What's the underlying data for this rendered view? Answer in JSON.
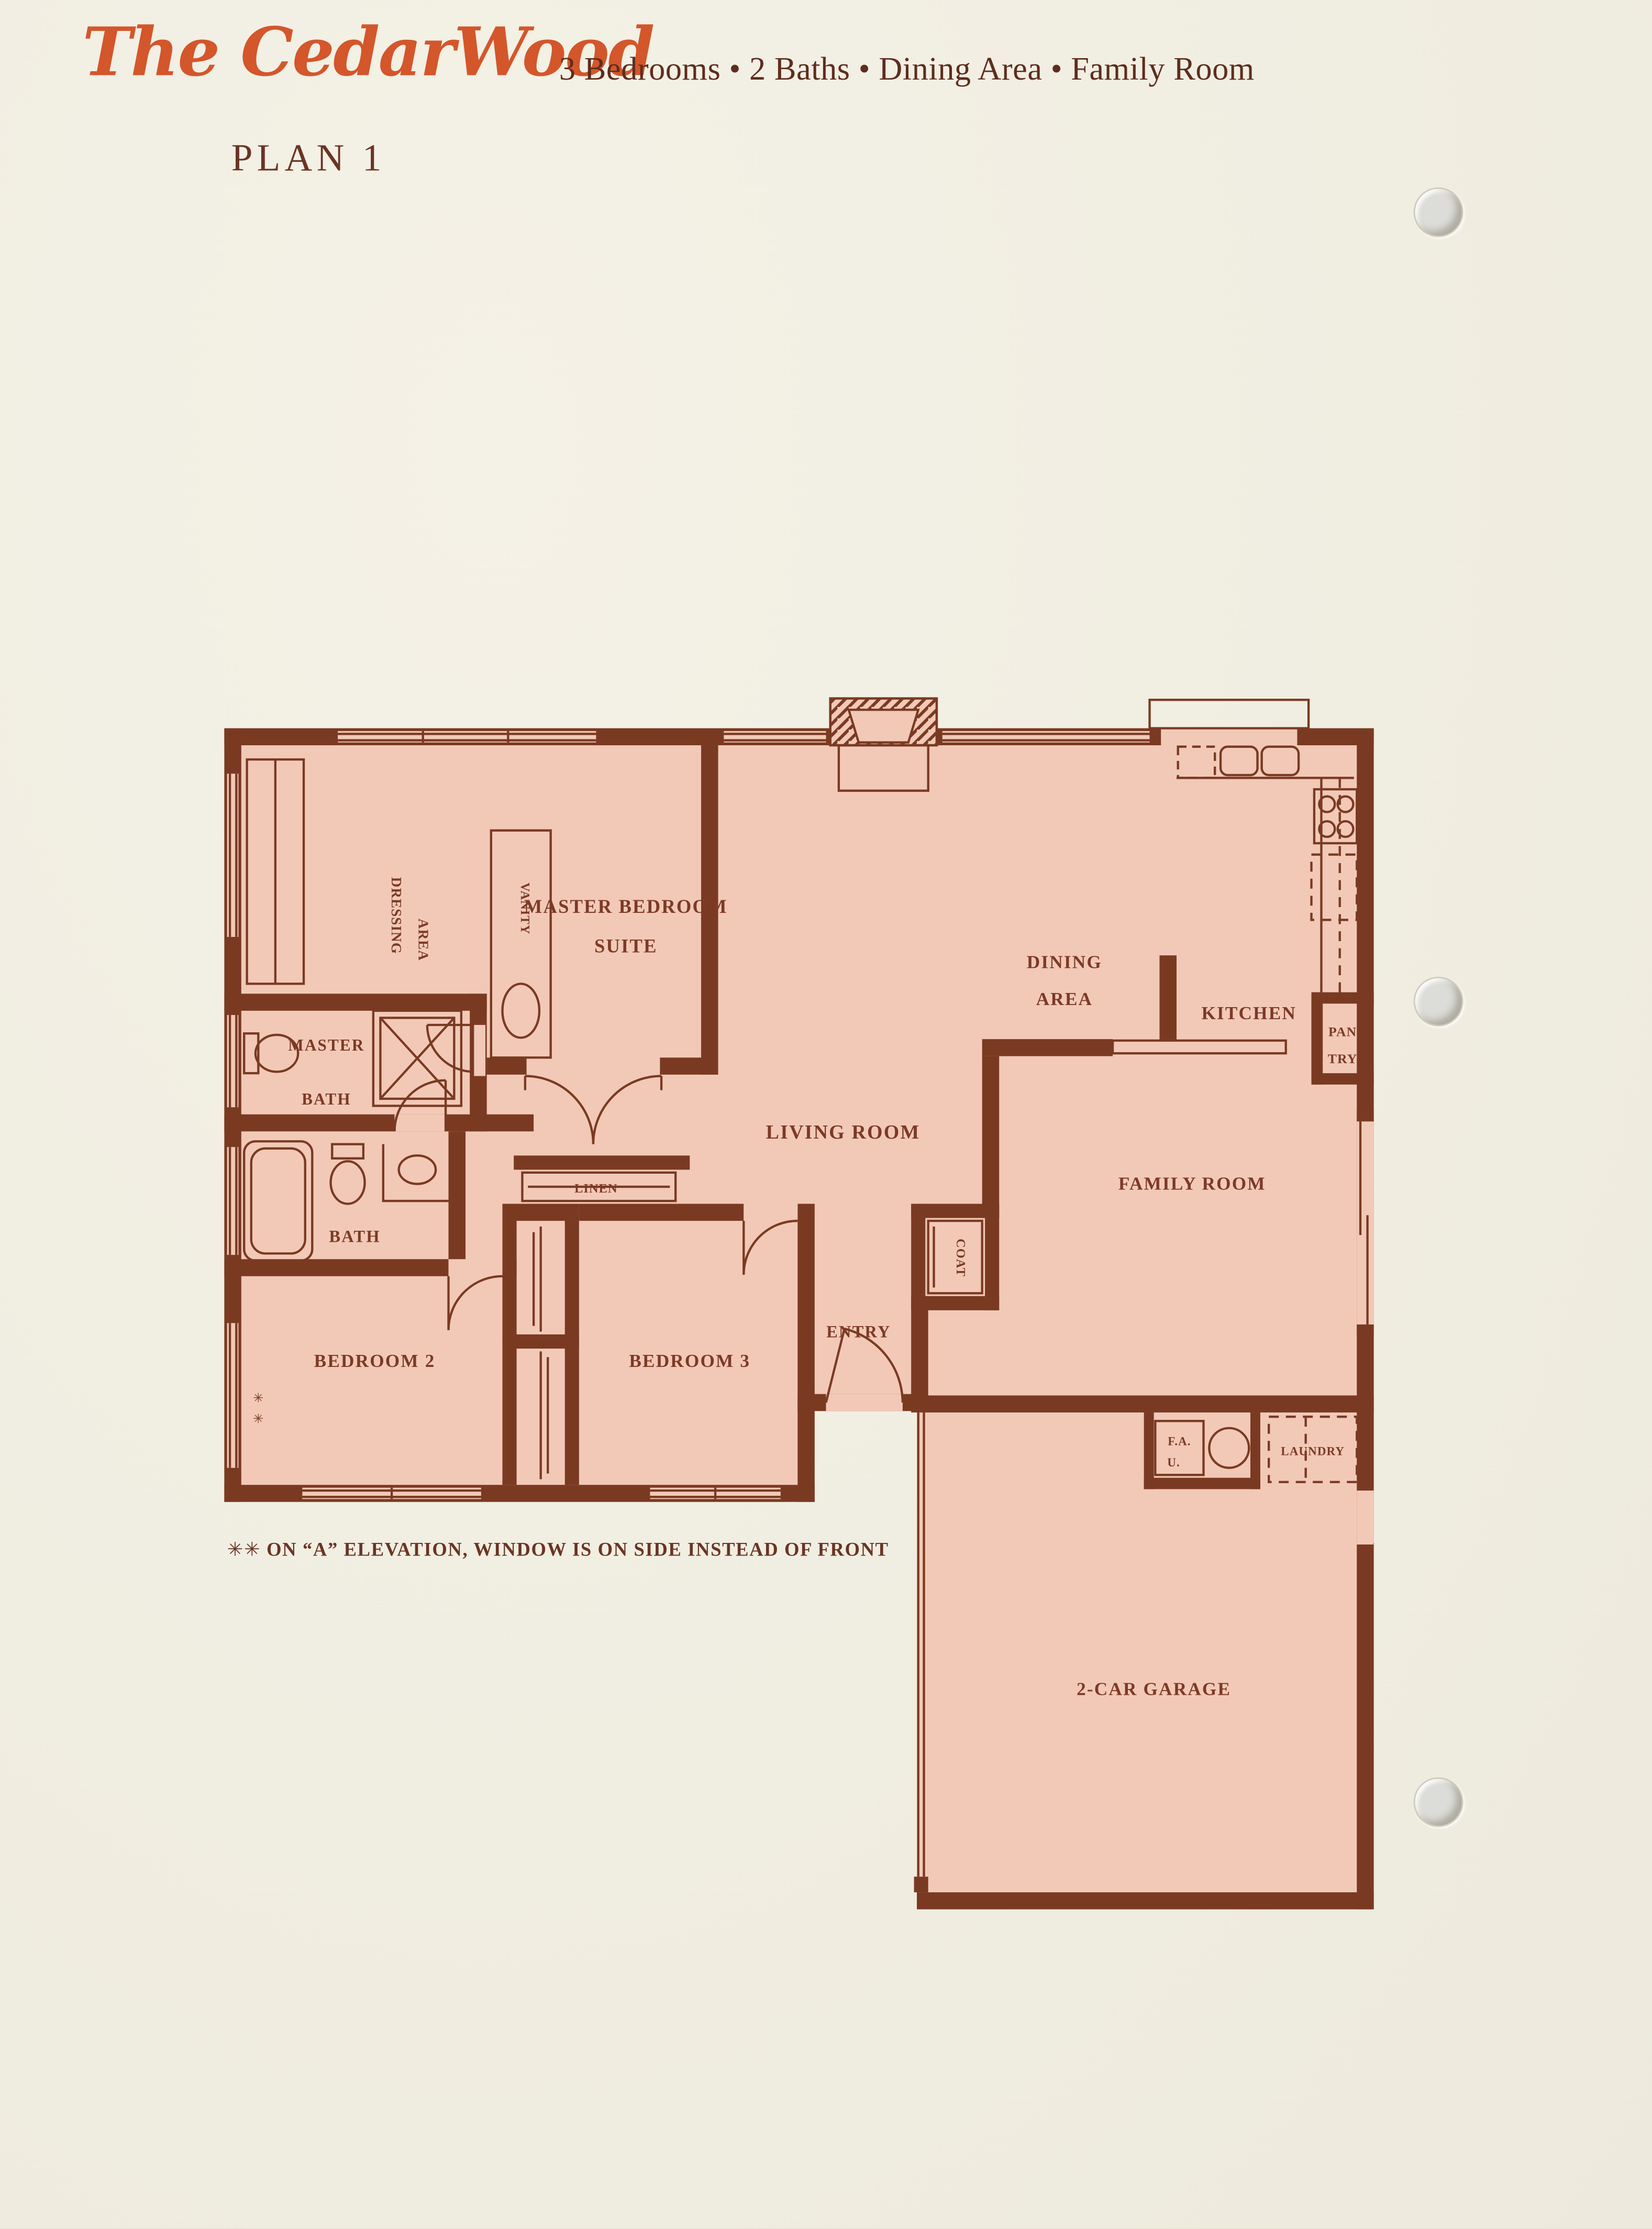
{
  "header": {
    "title": "The CedarWood",
    "subtitle": "3 Bedrooms  •  2 Baths  •  Dining Area  •  Family Room",
    "plan_label": "PLAN 1"
  },
  "floorplan": {
    "colors": {
      "wall_brown": "#7a3a22",
      "room_pink": "#f2c9b7",
      "label_brown": "#7c3a26",
      "page_cream": "#f1eee2",
      "title_orange": "#d4562b"
    },
    "labels": {
      "master_bedroom_1": "MASTER BEDROOM",
      "master_bedroom_2": "SUITE",
      "dressing_1": "DRESSING",
      "dressing_2": "AREA",
      "vanity": "VANITY",
      "master_bath_1": "MASTER",
      "master_bath_2": "BATH",
      "bath": "BATH",
      "linen": "LINEN",
      "bedroom2": "BEDROOM 2",
      "bedroom3": "BEDROOM 3",
      "entry": "ENTRY",
      "coat": "COAT",
      "living_room": "LIVING ROOM",
      "dining_1": "DINING",
      "dining_2": "AREA",
      "kitchen": "KITCHEN",
      "pantry_1": "PAN",
      "pantry_2": "TRY",
      "family_room": "FAMILY ROOM",
      "fau_1": "F.A.",
      "fau_2": "U.",
      "laundry": "LAUNDRY",
      "garage": "2-CAR GARAGE",
      "window_marks": "✳✳"
    }
  },
  "footnote": {
    "marks": "✳✳",
    "text": "ON “A” ELEVATION, WINDOW IS ON SIDE INSTEAD OF FRONT"
  }
}
